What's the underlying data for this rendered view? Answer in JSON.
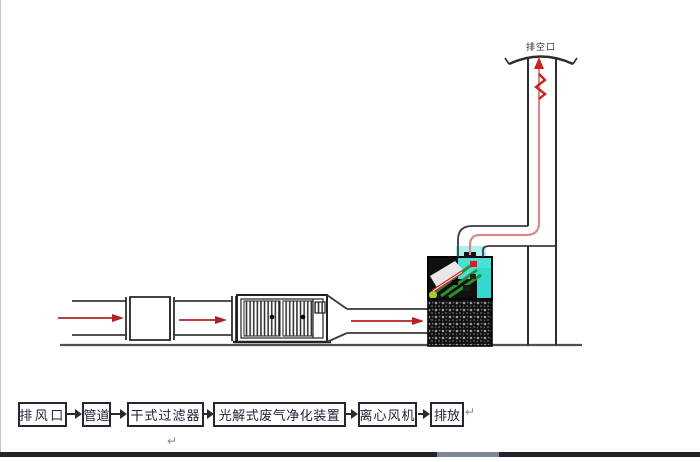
{
  "diagram": {
    "stack_label": "排空口",
    "colors": {
      "pipe_stroke": "#3a3a3a",
      "airflow_arrow": "#b22222",
      "flow_line": "#d98b8b",
      "ground": "#4f4f4f",
      "carbon_block": "#101010",
      "uv_glow": "#49e0d6",
      "uv_lamp_green": "#2e8f2e",
      "bottom_bar": "#23232b"
    }
  },
  "flow_chart": {
    "steps": [
      {
        "label": "排风口"
      },
      {
        "label": "管道"
      },
      {
        "label": "干式过滤器"
      },
      {
        "label": "光解式废气净化装置"
      },
      {
        "label": "离心风机"
      },
      {
        "label": "排放"
      }
    ],
    "return_mark": "↵"
  }
}
